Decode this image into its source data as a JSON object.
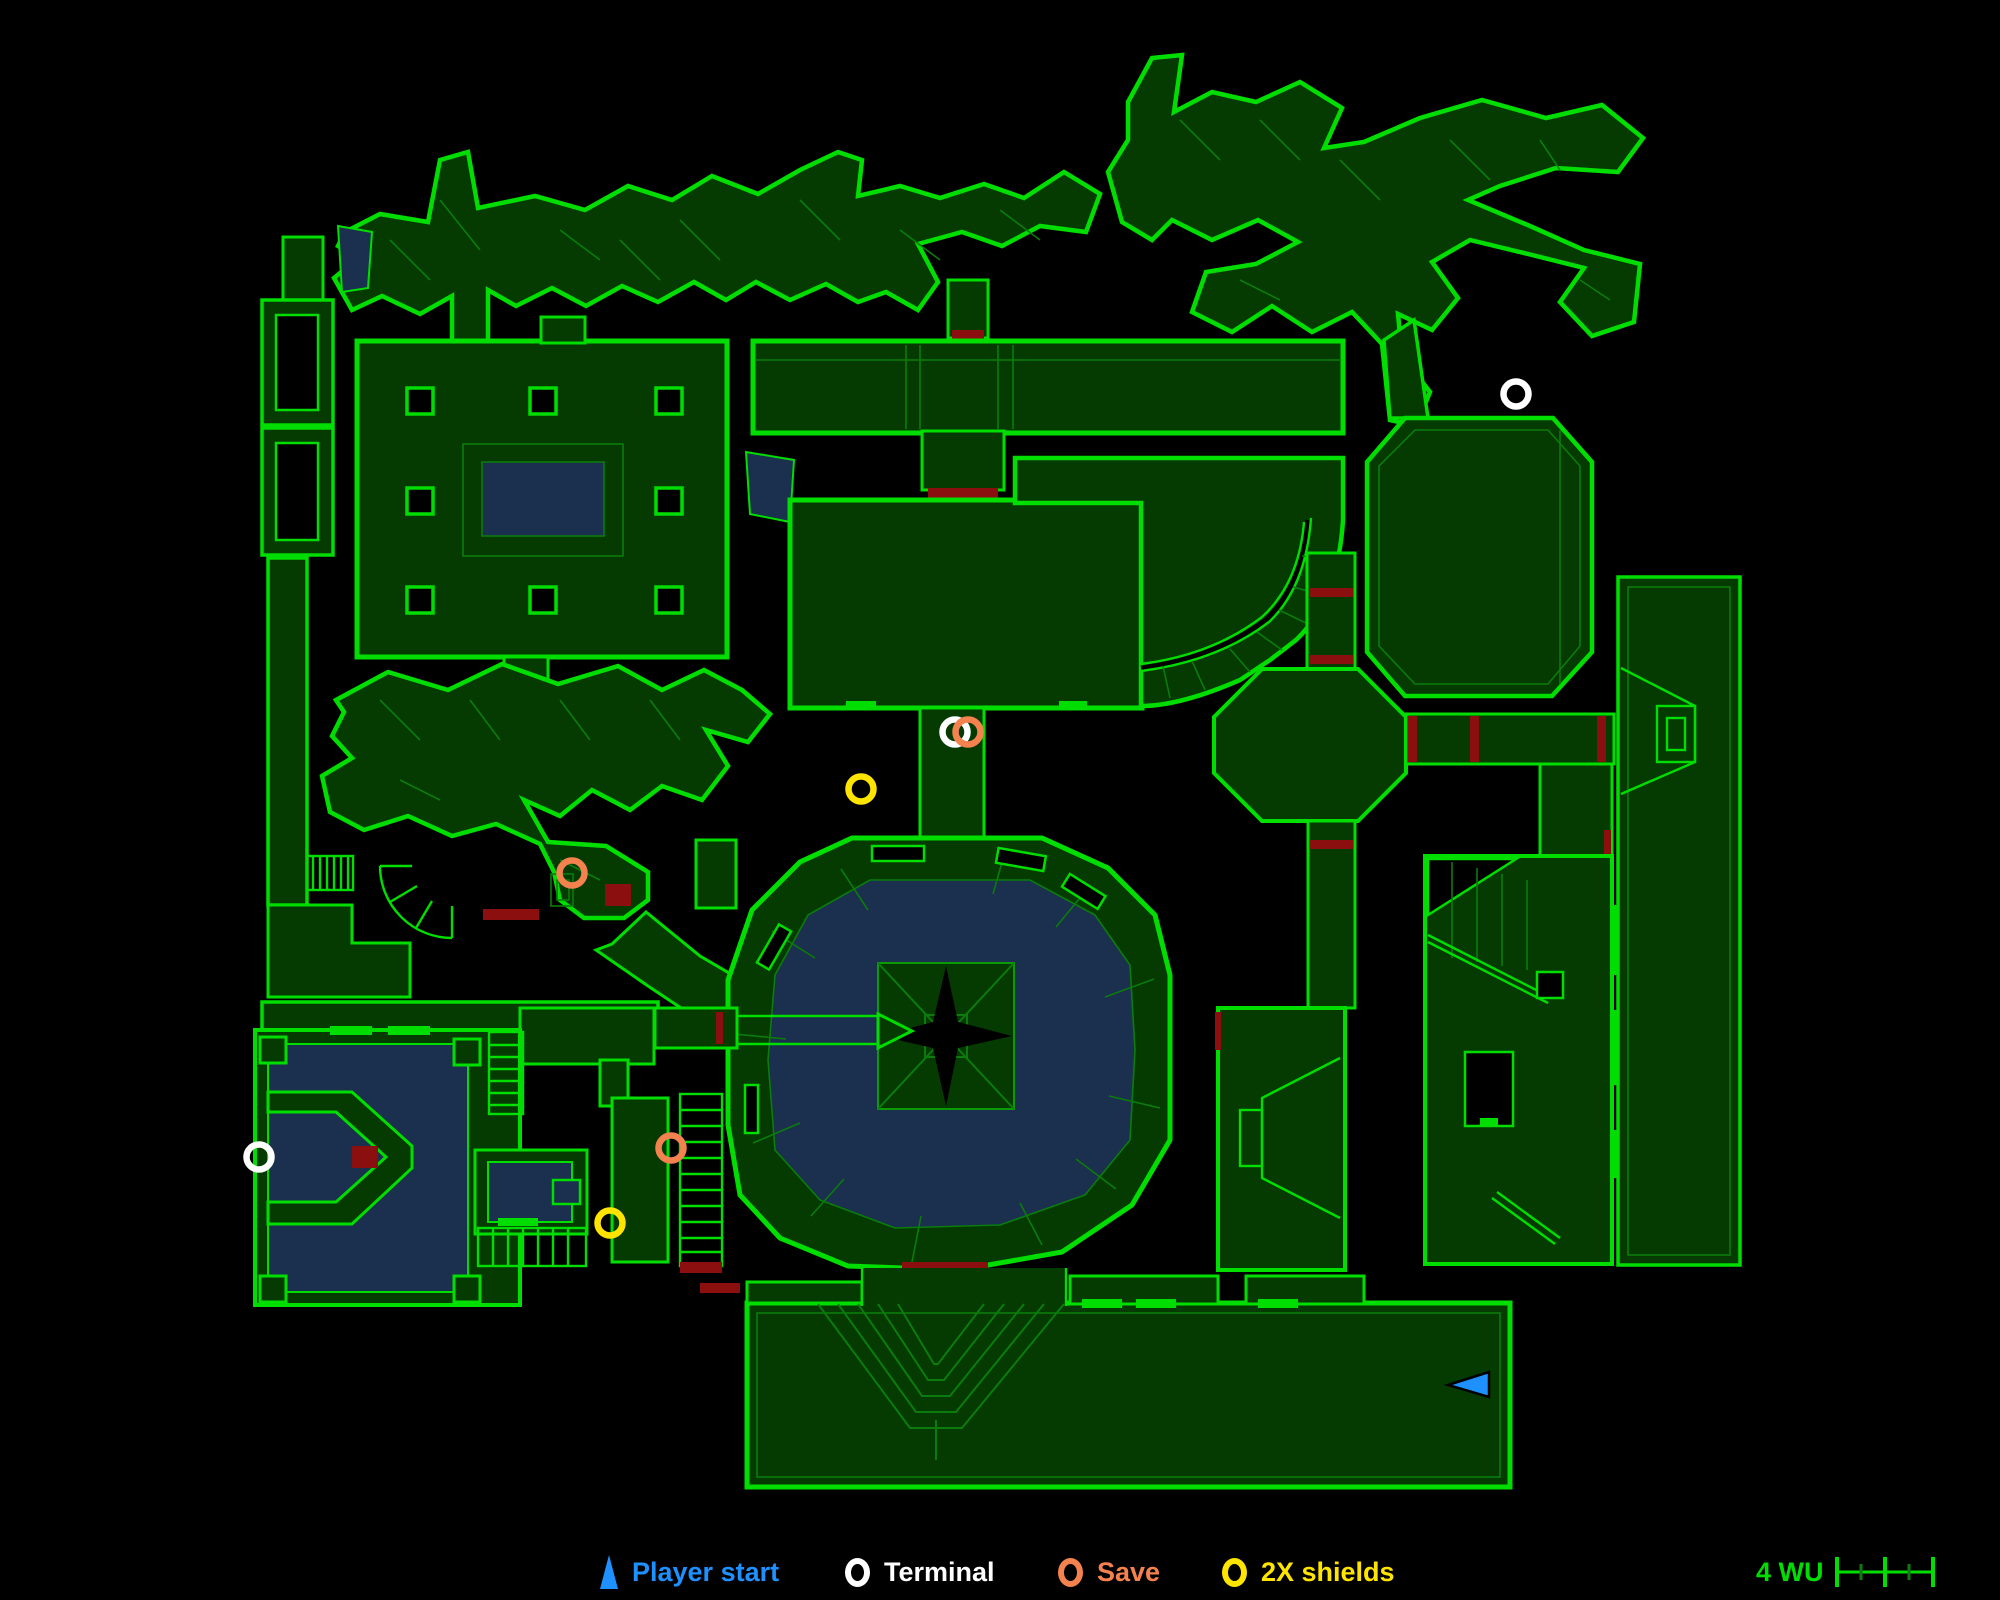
{
  "map": {
    "colors": {
      "background": "#000000",
      "wall_bright": "#00dd00",
      "line_dim": "#0b7c0b",
      "line_mid": "#0a9a0a",
      "room_fill": "#053a00",
      "water": "#1b2f4e",
      "door_red": "#8b0f0f",
      "markers": {
        "player": "#1e90ff",
        "terminal": "#ffffff",
        "save": "#f4824f",
        "shields": "#ffe400"
      }
    },
    "markers": [
      {
        "type": "terminal",
        "x": 1516,
        "y": 394
      },
      {
        "type": "terminal",
        "x": 955,
        "y": 732
      },
      {
        "type": "save",
        "x": 968,
        "y": 732
      },
      {
        "type": "shields",
        "x": 861,
        "y": 789
      },
      {
        "type": "save",
        "x": 572,
        "y": 873
      },
      {
        "type": "terminal",
        "x": 259,
        "y": 1157
      },
      {
        "type": "save",
        "x": 671,
        "y": 1148
      },
      {
        "type": "shields",
        "x": 610,
        "y": 1223
      },
      {
        "type": "player",
        "x": 1470,
        "y": 1384,
        "dir": "left"
      }
    ]
  },
  "legend": {
    "items": [
      {
        "id": "player-start",
        "label": "Player start",
        "color": "#1e90ff",
        "glyph": "triangle"
      },
      {
        "id": "terminal",
        "label": "Terminal",
        "color": "#ffffff",
        "glyph": "ring"
      },
      {
        "id": "save",
        "label": "Save",
        "color": "#f4824f",
        "glyph": "ring"
      },
      {
        "id": "2x-shields",
        "label": "2X shields",
        "color": "#ffe400",
        "glyph": "ring"
      }
    ]
  },
  "scale": {
    "label": "4 WU",
    "units": 4,
    "color": "#00dd00"
  }
}
